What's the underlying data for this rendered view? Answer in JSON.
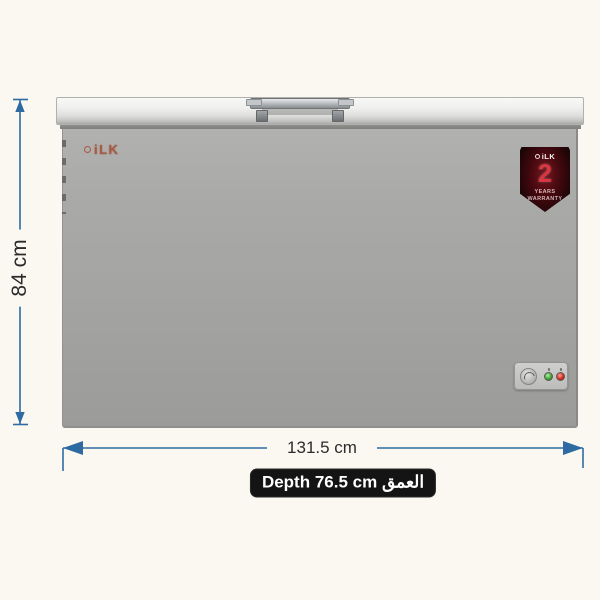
{
  "product": {
    "type": "chest-freezer",
    "brand": "iLK"
  },
  "badge": {
    "brand": "iLK",
    "years": "2",
    "line1": "YEARS",
    "line2": "WARRANTY"
  },
  "dimensions": {
    "height": "84 cm",
    "width": "131.5 cm",
    "depth_en": "Depth 76.5 cm",
    "depth_ar": "العمق"
  },
  "colors": {
    "background": "#faf8f1",
    "dimension_arrow": "#2e6ba3",
    "dimension_text": "#2b2b2b",
    "depth_label_bg": "#141414",
    "depth_label_text": "#ffffff",
    "freezer_body": "#a5a5a3",
    "freezer_lid": "#ececea",
    "brand_logo": "#a65a42",
    "badge_bg": "#2a070b",
    "badge_number": "#dd3540",
    "led_green": "#35a02c",
    "led_red": "#d32318"
  }
}
